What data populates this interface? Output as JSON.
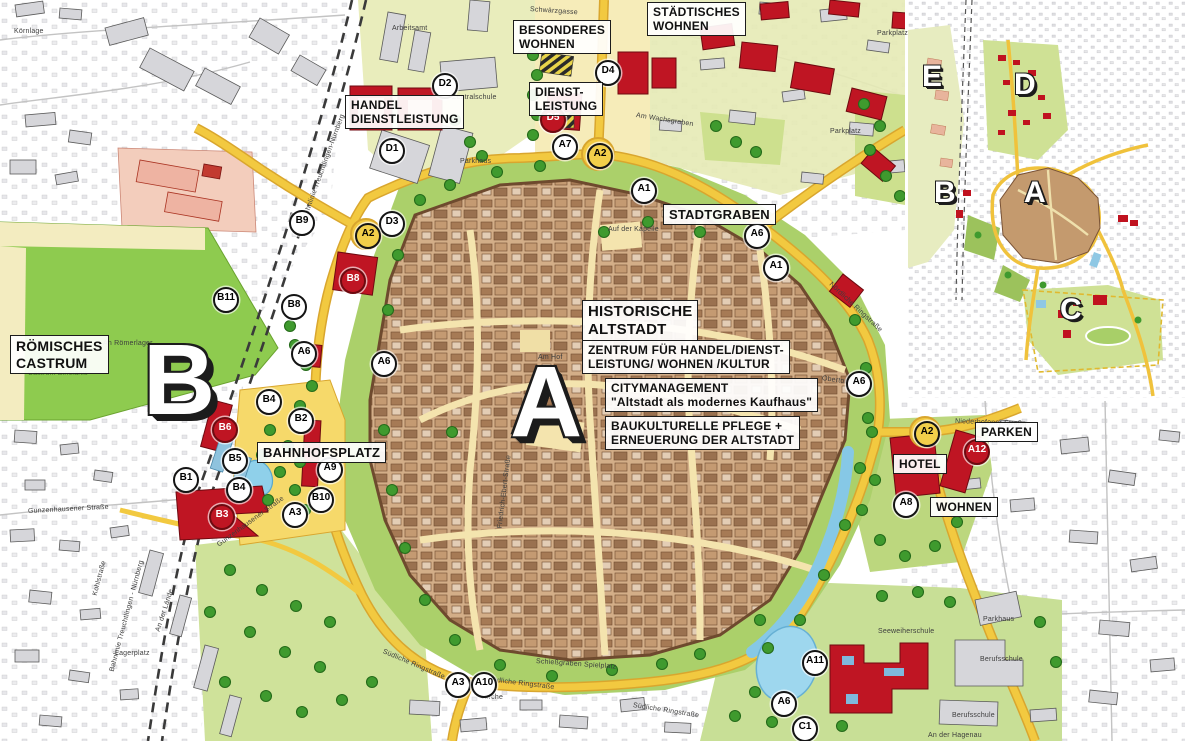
{
  "palette": {
    "road_yellow": "#f2c940",
    "accent_red": "#bf1523",
    "water_blue": "#8ecde9",
    "park_green": "#a9cf67",
    "oldtown_tan": "#d3ae88",
    "field_green": "#8ecb4f"
  },
  "main_map": {
    "area_labels": [
      {
        "id": "staedtisches-wohnen",
        "text": "STÄDTISCHES\nWOHNEN",
        "x": 647,
        "y": 2,
        "size": 12
      },
      {
        "id": "besonderes-wohnen",
        "text": "BESONDERES\nWOHNEN",
        "x": 513,
        "y": 20,
        "size": 12
      },
      {
        "id": "dienstleistung",
        "text": "DIENST-\nLEISTUNG",
        "x": 529,
        "y": 82,
        "size": 12
      },
      {
        "id": "handel-dienstleistung",
        "text": "HANDEL\nDIENSTLEISTUNG",
        "x": 345,
        "y": 95,
        "size": 12
      },
      {
        "id": "stadtgraben",
        "text": "STADTGRABEN",
        "x": 663,
        "y": 204,
        "size": 13
      },
      {
        "id": "historische-altstadt",
        "text": "HISTORISCHE\nALTSTADT",
        "x": 582,
        "y": 300,
        "size": 15
      },
      {
        "id": "zentrum-fuer-handel",
        "text": "ZENTRUM FÜR HANDEL/DIENST-\nLEISTUNG/ WOHNEN /KULTUR",
        "x": 582,
        "y": 340,
        "size": 12
      },
      {
        "id": "citymanagement",
        "text": "CITYMANAGEMENT\n\"Altstadt als modernes Kaufhaus\"",
        "x": 605,
        "y": 378,
        "size": 12
      },
      {
        "id": "baukulturelle-pflege",
        "text": "BAUKULTURELLE PFLEGE +\nERNEUERUNG DER ALTSTADT",
        "x": 605,
        "y": 416,
        "size": 12
      },
      {
        "id": "roemisches-castrum",
        "text": "RÖMISCHES\nCASTRUM",
        "x": 10,
        "y": 335,
        "size": 14
      },
      {
        "id": "bahnhofsplatz",
        "text": "BAHNHOFSPLATZ",
        "x": 257,
        "y": 442,
        "size": 13
      },
      {
        "id": "hotel",
        "text": "HOTEL",
        "x": 893,
        "y": 454,
        "size": 12
      },
      {
        "id": "parken",
        "text": "PARKEN",
        "x": 975,
        "y": 422,
        "size": 12
      },
      {
        "id": "wohnen",
        "text": "WOHNEN",
        "x": 930,
        "y": 497,
        "size": 12
      }
    ],
    "zone_letters": [
      {
        "letter": "B",
        "x": 143,
        "y": 330,
        "size": 100
      },
      {
        "letter": "A",
        "x": 510,
        "y": 352,
        "size": 100
      }
    ],
    "markers": [
      {
        "id": "D1",
        "x": 390,
        "y": 149,
        "style": "white"
      },
      {
        "id": "D2",
        "x": 443,
        "y": 84,
        "style": "white"
      },
      {
        "id": "D3",
        "x": 390,
        "y": 222,
        "style": "white"
      },
      {
        "id": "D4",
        "x": 606,
        "y": 71,
        "style": "white"
      },
      {
        "id": "D5",
        "x": 551,
        "y": 118,
        "style": "red"
      },
      {
        "id": "A7",
        "x": 563,
        "y": 145,
        "style": "white"
      },
      {
        "id": "A2",
        "x": 598,
        "y": 154,
        "style": "yellow"
      },
      {
        "id": "A2",
        "x": 366,
        "y": 234,
        "style": "yellow"
      },
      {
        "id": "A2",
        "x": 925,
        "y": 432,
        "style": "yellow"
      },
      {
        "id": "B9",
        "x": 300,
        "y": 221,
        "style": "white"
      },
      {
        "id": "B8",
        "x": 351,
        "y": 279,
        "style": "red"
      },
      {
        "id": "B8",
        "x": 292,
        "y": 305,
        "style": "white"
      },
      {
        "id": "B11",
        "x": 224,
        "y": 298,
        "style": "white"
      },
      {
        "id": "A6",
        "x": 302,
        "y": 352,
        "style": "white"
      },
      {
        "id": "A6",
        "x": 382,
        "y": 362,
        "style": "white"
      },
      {
        "id": "B4",
        "x": 267,
        "y": 400,
        "style": "white"
      },
      {
        "id": "B2",
        "x": 299,
        "y": 419,
        "style": "white"
      },
      {
        "id": "B6",
        "x": 223,
        "y": 428,
        "style": "red"
      },
      {
        "id": "B5",
        "x": 233,
        "y": 459,
        "style": "white"
      },
      {
        "id": "B1",
        "x": 184,
        "y": 478,
        "style": "white"
      },
      {
        "id": "B4",
        "x": 237,
        "y": 488,
        "style": "white"
      },
      {
        "id": "B3",
        "x": 220,
        "y": 515,
        "style": "red"
      },
      {
        "id": "A9",
        "x": 328,
        "y": 468,
        "style": "white"
      },
      {
        "id": "B10",
        "x": 319,
        "y": 498,
        "style": "white"
      },
      {
        "id": "A3",
        "x": 293,
        "y": 513,
        "style": "white"
      },
      {
        "id": "A1",
        "x": 642,
        "y": 189,
        "style": "white"
      },
      {
        "id": "A6",
        "x": 755,
        "y": 234,
        "style": "white"
      },
      {
        "id": "A1",
        "x": 774,
        "y": 266,
        "style": "white"
      },
      {
        "id": "A6",
        "x": 857,
        "y": 382,
        "style": "white"
      },
      {
        "id": "A12",
        "x": 975,
        "y": 450,
        "style": "red"
      },
      {
        "id": "A8",
        "x": 904,
        "y": 503,
        "style": "white"
      },
      {
        "id": "A3",
        "x": 456,
        "y": 683,
        "style": "white"
      },
      {
        "id": "A10",
        "x": 482,
        "y": 683,
        "style": "white"
      },
      {
        "id": "A11",
        "x": 813,
        "y": 661,
        "style": "white"
      },
      {
        "id": "A6",
        "x": 782,
        "y": 702,
        "style": "white"
      },
      {
        "id": "C1",
        "x": 803,
        "y": 727,
        "style": "white"
      }
    ],
    "street_labels": [
      {
        "text": "Körnlage",
        "x": 14,
        "y": 28,
        "angle": 0
      },
      {
        "text": "Schwärzgasse",
        "x": 530,
        "y": 6,
        "angle": 4
      },
      {
        "text": "Arbeitsamt",
        "x": 392,
        "y": 25,
        "angle": 0
      },
      {
        "text": "Zentralschule",
        "x": 452,
        "y": 94,
        "angle": 0
      },
      {
        "text": "Parkhaus",
        "x": 460,
        "y": 158,
        "angle": 0
      },
      {
        "text": "Am Wachsgraben",
        "x": 636,
        "y": 112,
        "angle": 9
      },
      {
        "text": "Parkplatz",
        "x": 830,
        "y": 128,
        "angle": 0
      },
      {
        "text": "Parkplatz",
        "x": 877,
        "y": 30,
        "angle": 0
      },
      {
        "text": "Bahnlinie Treuchtlingen-Nürnberg",
        "x": 305,
        "y": 215,
        "angle": -70
      },
      {
        "text": "Bahnlinie Treuchtlingen - Nürnberg",
        "x": 112,
        "y": 668,
        "angle": -75
      },
      {
        "text": "Kohlstraße",
        "x": 95,
        "y": 592,
        "angle": -75
      },
      {
        "text": "Lagerplatz",
        "x": 115,
        "y": 650,
        "angle": 0
      },
      {
        "text": "An der Lände",
        "x": 158,
        "y": 628,
        "angle": -72
      },
      {
        "text": "Gunzenhausener Straße",
        "x": 28,
        "y": 508,
        "angle": -3
      },
      {
        "text": "Gunzenhausener Straße",
        "x": 218,
        "y": 542,
        "angle": -36
      },
      {
        "text": "Südliche Ringstraße",
        "x": 383,
        "y": 648,
        "angle": 23
      },
      {
        "text": "Südliche Ringstraße",
        "x": 488,
        "y": 676,
        "angle": 7
      },
      {
        "text": "Südliche Ringstraße",
        "x": 633,
        "y": 702,
        "angle": 9
      },
      {
        "text": "Nördliche Ringstraße",
        "x": 830,
        "y": 280,
        "angle": 43
      },
      {
        "text": "Obertorstraße",
        "x": 822,
        "y": 375,
        "angle": 8
      },
      {
        "text": "An Römerlager",
        "x": 103,
        "y": 340,
        "angle": 0
      },
      {
        "text": "Castrum Biricianis",
        "x": 28,
        "y": 370,
        "angle": 0,
        "cls": "green"
      },
      {
        "text": "Friedrich-Ebert-Straße",
        "x": 500,
        "y": 525,
        "angle": -83
      },
      {
        "text": "Am Hof",
        "x": 538,
        "y": 354,
        "angle": 0
      },
      {
        "text": "Auf der Kapelle",
        "x": 608,
        "y": 226,
        "angle": 0
      },
      {
        "text": "Niederhofener Straße",
        "x": 955,
        "y": 418,
        "angle": 2
      },
      {
        "text": "Seeweiherschule",
        "x": 878,
        "y": 628,
        "angle": 0
      },
      {
        "text": "Parkhaus",
        "x": 983,
        "y": 616,
        "angle": 0
      },
      {
        "text": "Berufsschule",
        "x": 980,
        "y": 656,
        "angle": 0
      },
      {
        "text": "Berufsschule",
        "x": 952,
        "y": 712,
        "angle": 0
      },
      {
        "text": "An der Hagenau",
        "x": 928,
        "y": 732,
        "angle": 0
      },
      {
        "text": "Schießgraben Spielplatz",
        "x": 536,
        "y": 658,
        "angle": 4
      },
      {
        "text": "Kirche",
        "x": 482,
        "y": 694,
        "angle": 0
      }
    ]
  },
  "inset_map": {
    "zone_letters": [
      {
        "letter": "E",
        "x": 14,
        "y": 62,
        "size": 30
      },
      {
        "letter": "D",
        "x": 106,
        "y": 70,
        "size": 30
      },
      {
        "letter": "B",
        "x": 26,
        "y": 178,
        "size": 30
      },
      {
        "letter": "A",
        "x": 116,
        "y": 178,
        "size": 30
      },
      {
        "letter": "C",
        "x": 152,
        "y": 295,
        "size": 30
      }
    ]
  }
}
